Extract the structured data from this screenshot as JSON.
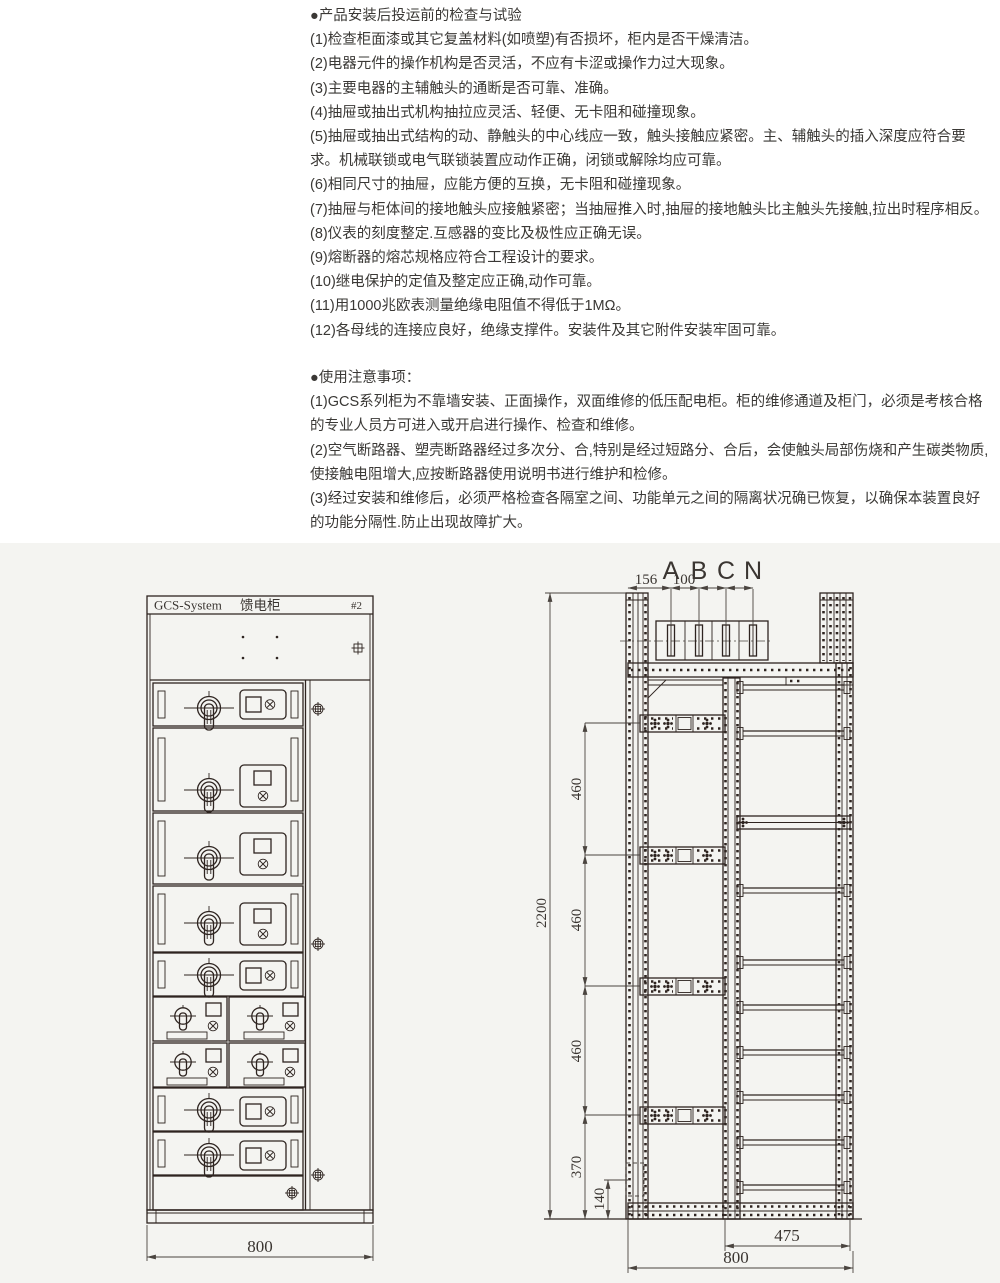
{
  "inspection": {
    "title": "●产品安装后投运前的检查与试验",
    "items": [
      "(1)检查柜面漆或其它复盖材料(如喷塑)有否损坏，柜内是否干燥清洁。",
      "(2)电器元件的操作机构是否灵活，不应有卡涩或操作力过大现象。",
      "(3)主要电器的主辅触头的通断是否可靠、准确。",
      "(4)抽屉或抽出式机构抽拉应灵活、轻便、无卡阻和碰撞现象。",
      "(5)抽屉或抽出式结构的动、静触头的中心线应一致，触头接触应紧密。主、辅触头的插入深度应符合要求。机械联锁或电气联锁装置应动作正确，闭锁或解除均应可靠。",
      "(6)相同尺寸的抽屉，应能方便的互换，无卡阻和碰撞现象。",
      "(7)抽屉与柜体间的接地触头应接触紧密；当抽屉推入时,抽屉的接地触头比主触头先接触,拉出时程序相反。",
      "(8)仪表的刻度整定.互感器的变比及极性应正确无误。",
      "(9)熔断器的熔芯规格应符合工程设计的要求。",
      "(10)继电保护的定值及整定应正确,动作可靠。",
      "(11)用1000兆欧表测量绝缘电阻值不得低于1MΩ。",
      "(12)各母线的连接应良好，绝缘支撑件。安装件及其它附件安装牢固可靠。"
    ]
  },
  "usage": {
    "title": "●使用注意事项：",
    "items": [
      "(1)GCS系列柜为不靠墙安装、正面操作，双面维修的低压配电柜。柜的维修通道及柜门，必须是考核合格的专业人员方可进入或开启进行操作、检查和维修。",
      "(2)空气断路器、塑壳断路器经过多次分、合,特别是经过短路分、合后，会使触头局部伤烧和产生碳类物质,使接触电阻增大,应按断路器使用说明书进行维护和检修。",
      "(3)经过安装和维修后，必须严格检查各隔室之间、功能单元之间的隔离状况确已恢复，以确保本装置良好的功能分隔性.防止出现故障扩大。"
    ]
  },
  "front_view": {
    "title_brand": "GCS-System",
    "title_name": "馈电柜",
    "title_tag": "#2",
    "dim_width": "800"
  },
  "side_view": {
    "phases": [
      "A",
      "B",
      "C",
      "N"
    ],
    "dim_busbar_offset": "156",
    "dim_busbar_pitch": "100",
    "dim_height": "2200",
    "dim_section_1": "460",
    "dim_section_2": "460",
    "dim_section_3": "460",
    "dim_bottom_section": "370",
    "dim_base": "140",
    "dim_inner_depth": "475",
    "dim_depth": "800"
  },
  "colors": {
    "line": "#2e2420",
    "band_bg": "#f4f4f1",
    "text": "#3a3835"
  }
}
